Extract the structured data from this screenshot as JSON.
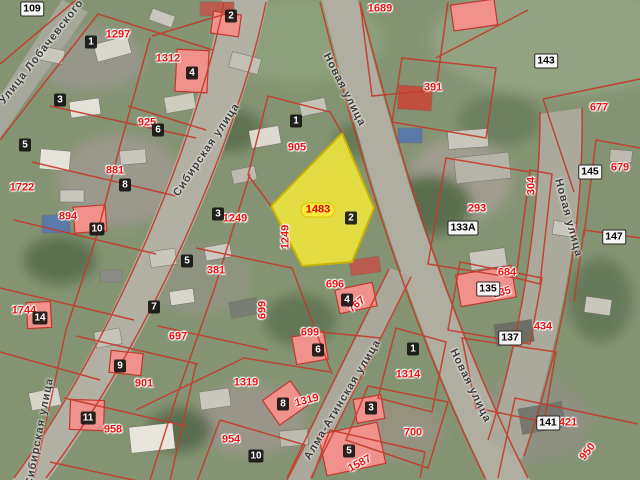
{
  "map": {
    "type": "cadastral-satellite-map",
    "selected_parcel": {
      "cadastral_number": "1483",
      "house_number": "2"
    },
    "highlighted_number": {
      "text": "1483",
      "x": 318,
      "y": 210
    },
    "street_names": [
      {
        "text": "Улица Лобачевского",
        "x": 42,
        "y": 52,
        "rot": -52
      },
      {
        "text": "Сибирская улица",
        "x": 207,
        "y": 150,
        "rot": -56
      },
      {
        "text": "Сибирская улица",
        "x": 40,
        "y": 432,
        "rot": -79
      },
      {
        "text": "Новая улица",
        "x": 344,
        "y": 90,
        "rot": 63
      },
      {
        "text": "Новая улица",
        "x": 568,
        "y": 218,
        "rot": 75
      },
      {
        "text": "Новая улица",
        "x": 470,
        "y": 386,
        "rot": 64
      },
      {
        "text": "Алма-Атинская улица",
        "x": 343,
        "y": 400,
        "rot": -59
      }
    ],
    "parcel_numbers": [
      {
        "text": "1297",
        "x": 118,
        "y": 35
      },
      {
        "text": "1312",
        "x": 168,
        "y": 59
      },
      {
        "text": "1689",
        "x": 380,
        "y": 9
      },
      {
        "text": "391",
        "x": 433,
        "y": 88
      },
      {
        "text": "677",
        "x": 599,
        "y": 108
      },
      {
        "text": "925",
        "x": 147,
        "y": 123
      },
      {
        "text": "905",
        "x": 297,
        "y": 148
      },
      {
        "text": "881",
        "x": 115,
        "y": 171
      },
      {
        "text": "1722",
        "x": 22,
        "y": 188
      },
      {
        "text": "293",
        "x": 477,
        "y": 209
      },
      {
        "text": "304",
        "x": 532,
        "y": 186,
        "rot": -90
      },
      {
        "text": "679",
        "x": 620,
        "y": 168
      },
      {
        "text": "894",
        "x": 68,
        "y": 217
      },
      {
        "text": "1249",
        "x": 235,
        "y": 219
      },
      {
        "text": "1249",
        "x": 286,
        "y": 237,
        "rot": -90
      },
      {
        "text": "381",
        "x": 216,
        "y": 271
      },
      {
        "text": "684",
        "x": 507,
        "y": 273
      },
      {
        "text": "696",
        "x": 335,
        "y": 285
      },
      {
        "text": "235",
        "x": 502,
        "y": 293,
        "rot": -15
      },
      {
        "text": "699",
        "x": 263,
        "y": 310,
        "rot": -90
      },
      {
        "text": "767",
        "x": 357,
        "y": 305,
        "rot": -40
      },
      {
        "text": "1744",
        "x": 24,
        "y": 311
      },
      {
        "text": "434",
        "x": 543,
        "y": 327
      },
      {
        "text": "699",
        "x": 310,
        "y": 333
      },
      {
        "text": "697",
        "x": 178,
        "y": 337
      },
      {
        "text": "1314",
        "x": 408,
        "y": 375
      },
      {
        "text": "901",
        "x": 144,
        "y": 384
      },
      {
        "text": "1319",
        "x": 246,
        "y": 383
      },
      {
        "text": "1319",
        "x": 307,
        "y": 401,
        "rot": -15
      },
      {
        "text": "421",
        "x": 568,
        "y": 423
      },
      {
        "text": "958",
        "x": 113,
        "y": 430
      },
      {
        "text": "700",
        "x": 413,
        "y": 433
      },
      {
        "text": "954",
        "x": 231,
        "y": 440
      },
      {
        "text": "950",
        "x": 588,
        "y": 452,
        "rot": -52
      },
      {
        "text": "1587",
        "x": 360,
        "y": 464,
        "rot": -28
      }
    ],
    "house_numbers": [
      {
        "text": "1",
        "x": 91,
        "y": 42
      },
      {
        "text": "2",
        "x": 231,
        "y": 16
      },
      {
        "text": "4",
        "x": 192,
        "y": 73
      },
      {
        "text": "3",
        "x": 60,
        "y": 100
      },
      {
        "text": "1",
        "x": 296,
        "y": 121
      },
      {
        "text": "6",
        "x": 158,
        "y": 130
      },
      {
        "text": "5",
        "x": 25,
        "y": 145
      },
      {
        "text": "8",
        "x": 125,
        "y": 185
      },
      {
        "text": "3",
        "x": 218,
        "y": 214
      },
      {
        "text": "2",
        "x": 351,
        "y": 218
      },
      {
        "text": "10",
        "x": 97,
        "y": 229
      },
      {
        "text": "5",
        "x": 187,
        "y": 261
      },
      {
        "text": "4",
        "x": 347,
        "y": 300
      },
      {
        "text": "7",
        "x": 154,
        "y": 307
      },
      {
        "text": "14",
        "x": 40,
        "y": 318
      },
      {
        "text": "1",
        "x": 413,
        "y": 349
      },
      {
        "text": "6",
        "x": 318,
        "y": 350
      },
      {
        "text": "9",
        "x": 120,
        "y": 366
      },
      {
        "text": "8",
        "x": 283,
        "y": 404
      },
      {
        "text": "3",
        "x": 371,
        "y": 408
      },
      {
        "text": "11",
        "x": 88,
        "y": 418
      },
      {
        "text": "5",
        "x": 349,
        "y": 451
      },
      {
        "text": "10",
        "x": 256,
        "y": 456
      }
    ],
    "address_labels": [
      {
        "text": "109",
        "x": 32,
        "y": 9
      },
      {
        "text": "143",
        "x": 546,
        "y": 61
      },
      {
        "text": "145",
        "x": 590,
        "y": 172
      },
      {
        "text": "133А",
        "x": 463,
        "y": 228
      },
      {
        "text": "147",
        "x": 614,
        "y": 237
      },
      {
        "text": "135",
        "x": 488,
        "y": 289
      },
      {
        "text": "137",
        "x": 510,
        "y": 338
      },
      {
        "text": "141",
        "x": 548,
        "y": 423
      }
    ],
    "colors": {
      "parcel_boundary": "#c23b2a",
      "parcel_number_red": "#ee1111",
      "highlight_fill": "#f3ea3b",
      "highlight_border": "#c8b400",
      "highlighted_building_fill": "#f0918c",
      "road": "#b2afa3",
      "terrain_base": "#849472"
    }
  }
}
